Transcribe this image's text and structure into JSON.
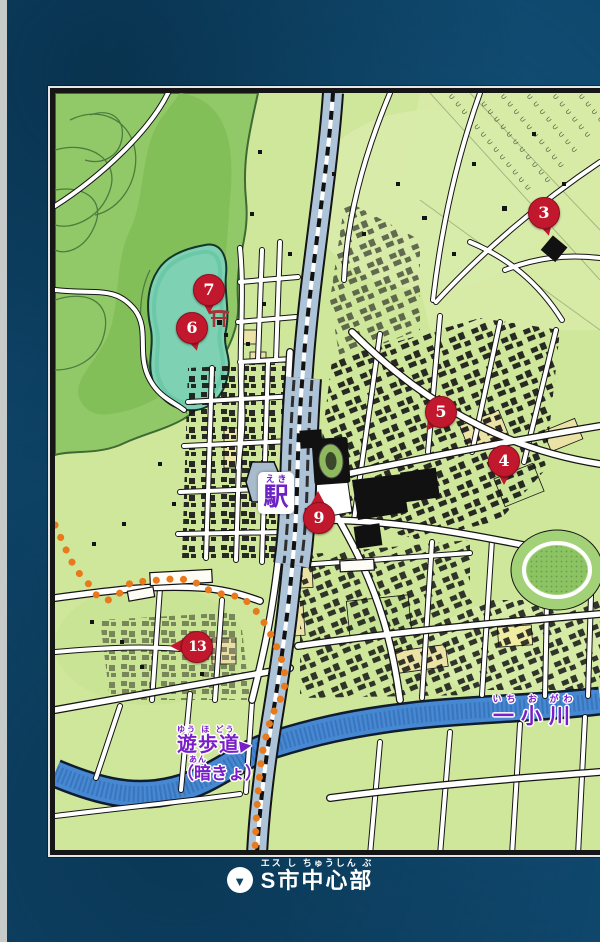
{
  "map_labels": {
    "station": {
      "furigana": "えき",
      "text": "駅"
    },
    "promenade": {
      "furigana": "ゆう ほ どう",
      "text": "遊歩道",
      "arrow": "▶"
    },
    "culvert": {
      "furigana": "あん",
      "text": "（暗きょ）"
    },
    "river": {
      "furigana": "いち お がわ",
      "text": "一小川"
    }
  },
  "markers": [
    {
      "label": "3"
    },
    {
      "label": "4"
    },
    {
      "label": "5"
    },
    {
      "label": "6"
    },
    {
      "label": "7"
    },
    {
      "label": "9"
    },
    {
      "label": "13"
    }
  ],
  "caption": {
    "furigana": "エス し ちゅうしん ぶ",
    "text": "S市中心部",
    "icon": "▼"
  },
  "colors": {
    "background_navy": "#0e456a",
    "land_green": "#cfe79b",
    "forest_green": "#92c968",
    "lake_teal": "#7ed1b3",
    "river_blue": "#4788d2",
    "railway_gray": "#adc3d8",
    "marker_red": "#c2182e",
    "label_purple": "#7a1ec8",
    "path_orange": "#e8791c"
  }
}
